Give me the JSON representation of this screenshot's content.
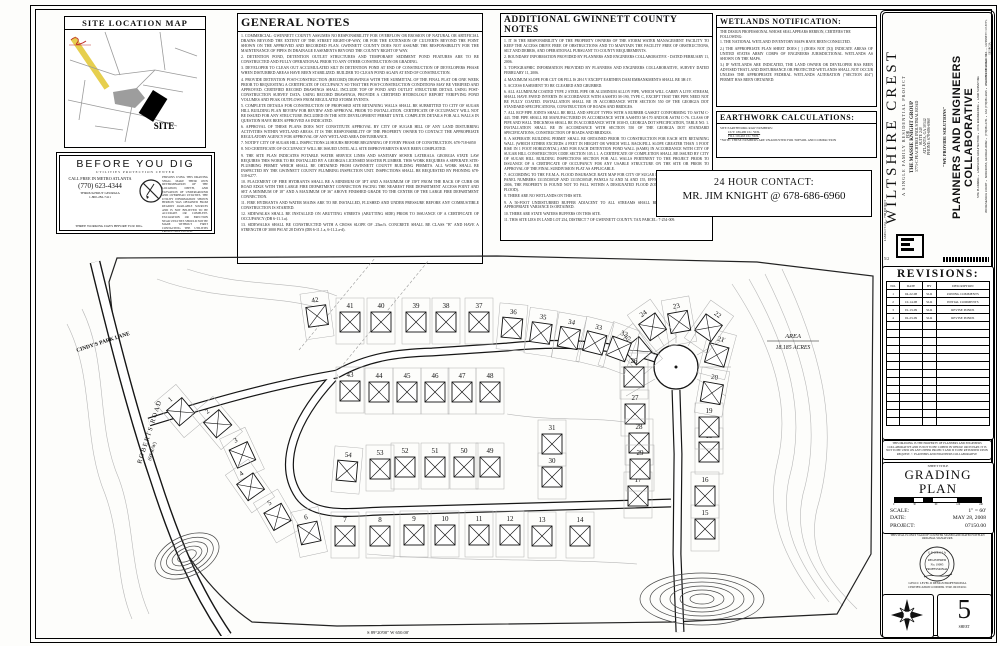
{
  "site_map": {
    "title": "SITE LOCATION MAP",
    "site_label": "SITE"
  },
  "before_you_dig": {
    "title": "BEFORE  YOU  DIG",
    "subtitle": "UTILITIES  PROTECTION  CENTER",
    "call_line": "CALL FREE IN METRO ATLANTA",
    "phone": "(770) 623-4344",
    "line2": "THROUGHOUT GEORGIA",
    "phone2": "1-800-282-7411",
    "bottom": "THREE  WORKING  DAYS  BEFORE  YOU  DIG.",
    "disclaimer": "PERSONS USING THIS DRAWING SHALL MAKE THEIR OWN DETERMINATION OF THE LOCATION, DEPTH, AND ELEVATION OF UNDERGROUND AND OVERHEAD UTILITIES. THE UTILITY INFORMATION SHOWN HEREON WAS OBTAINED FROM READILY AVAILABLE SOURCES AND IS NOT BELIEVED TO BE ACCURATE OR COMPLETE. EXCAVATION OR ERECTION NEAR UTILITIES SHOULD NOT BE MADE WITHOUT FIRST CONTACTING THE UTILITIES PROTECTION CENTER."
  },
  "general_notes": {
    "title": "GENERAL NOTES",
    "notes": [
      "1. COMMERCIAL: GWINNETT COUNTY ASSUMES NO RESPONSIBILITY FOR OVERFLOW OR EROSION OF NATURAL OR ARTIFICIAL DRAINS BEYOND THE EXTENT OF THE STREET RIGHT-OF-WAY, OR FOR THE EXTENSION OF CULVERTS BEYOND THE POINT SHOWN ON THE APPROVED AND RECORDED PLAN. GWINNETT COUNTY DOES NOT ASSUME THE RESPONSIBILITY FOR THE MAINTENANCE OF PIPES IN DRAINAGE EASEMENTS BEYOND THE COUNTY RIGHT OF WAY.",
      "2. DETENTION POND, DETENTION OUTLET STRUCTURES AND TEMPORARY SEDIMENT POND FEATURES ARE TO BE CONSTRUCTED AND FULLY OPERATIONAL PRIOR TO ANY OTHER CONSTRUCTION OR GRADING.",
      "3. DEVELOPER TO CLEAN OUT ACCUMULATED SILT IN DETENTION POND AT END OF CONSTRUCTION OF DEVELOPERS PHASE WHEN DISTURBED AREAS HAVE BEEN STABILIZED. BUILDER TO CLEAN POND AGAIN AT END OF CONSTRUCTION.",
      "4. PROVIDE DETENTION POST-CONSTRUCTION (RECORD) DRAWINGS WITH THE SUBMITTAL OF THE FINAL PLAT OR ONE WEEK PRIOR TO REQUESTING A CERTIFICATE OF OCCUPANCY SO THAT THE POST-CONSTRUCTION CONDITIONS MAY BE VERIFIED AND APPROVED. CERTIFIED RECORD DRAWINGS SHALL INCLUDE TOP OF POND AND OUTLET STRUCTURE DETAIL USING POST-CONSTRUCTION SURVEY DATA. USING RECORD DRAWINGS, PROVIDE A CERTIFIED HYDROLOGY REPORT VERIFYING POND VOLUMES AND PEAK OUTFLOWS FROM REGULATED STORM EVENTS.",
      "5. COMPLETE DETAILS FOR CONSTRUCTION OF PROPOSED SITE RETAINING WALLS SHALL BE SUBMITTED TO CITY OF SUGAR HILL BUILDING PLAN REVIEW FOR REVIEW AND APPROVAL PRIOR TO INSTALLATION. CERTIFICATE OF OCCUPANCY WILL NOT BE ISSUED FOR ANY STRUCTURE INCLUDED IN THE SITE DEVELOPMENT PERMIT UNTIL COMPLETE DETAILS FOR ALL WALLS IN QUESTION HAVE BEEN APPROVED AS INDICATED.",
      "6. APPROVAL OF THESE PLANS DOES NOT CONSTITUTE APPROVAL BY CITY OF SUGAR HILL OF ANY LAND DISTURBING ACTIVITIES WITHIN WETLAND AREAS. IT IS THE RESPONSIBILITY OF THE PROPERTY OWNER TO CONTACT THE APPROPRIATE REGULATORY AGENCY FOR APPROVAL OF ANY WETLAND AREA DISTURBANCE.",
      "7. NOTIFY CITY OF SUGAR HILL INSPECTIONS 24 HOURS BEFORE BEGINNING OF EVERY PHASE OF CONSTRUCTION. 678-718-6050",
      "8. NO CERTIFICATE OF OCCUPANCY WILL BE ISSUED UNTIL ALL SITE IMPROVEMENTS HAVE BEEN COMPLETED.",
      "9. THE SITE PLAN INDICATES POTABLE WATER SERVICE LINES AND SANITARY SEWER LATERALS. GEORGIA STATE LAW REQUIRES THIS WORK TO BE INSTALLED BY A GEORGIA LICENSED MASTER PLUMBER. THIS WORK REQUIRES A SEPERATE SITE-PLUMBING PERMIT WHICH SHALL BE OBTAINED FROM GWINNETT COUNTY BUILDING PERMITS. ALL WORK SHALL BE INSPECTED BY THE GWINNETT COUNTY PLUMBING INSPECTION UNIT. INSPECTIONS SHALL BE REQUESTED BY PHONING 678-518-6277.",
      "10. PLACEMENT OF FIRE HYDRANTS SHALL BE A MINIMUM OF 3FT AND A MAXIMUM OF 15FT FROM THE BACK OF CURB OR ROAD EDGE WITH THE LARGE FIRE DEPARTMENT CONNECTION FACING THE NEAREST FIRE DEPARTMENT ACCESS POINT AND SET A MINIMUM OF 18\" AND A MAXIMUM OF 36\" ABOVE FINISHED GRADE TO THE CENTER OF THE LARGE FIRE DEPARTMENT CONNECTION.",
      "11. FIRE HYDRANTS AND WATER MAINS ARE TO BE INSTALLED, FLUSHED AND UNDER PRESSURE BEFORE ANY COMBUSTIBLE CONSTRUCTION IS STARTED.",
      "12. SIDEWALKS SHALL BE INSTALLED ON ABUTTING STREETS (ABUTTING SIDE) PRIOR TO ISSUANCE OF A CERTIFICATE OF OCCUPANCY (DB 6-11.1.a).",
      "13. SIDEWALKS SHALL BE CONSTRUCTED WITH A CROSS SLOPE OF .25in/ft. CONCRETE SHALL BE CLASS \"B\" AND HAVE A STRENGTH OF 3000 PSI AT 28 DAYS (DB 6-11.1.a, 6-11.2.a-d)."
    ]
  },
  "county_notes": {
    "title": "ADDITIONAL GWINNETT COUNTY NOTES",
    "notes": [
      "1. IT IS THE RESPONSIBILITY OF THE PROPERTY OWNERS OF THE STORM WATER MANAGEMENT FACILITY TO KEEP THE ACCESS DRIVE FREE OF OBSTRUCTIONS AND TO MAINTAIN THE FACILITY FREE OF OBSTRUCTIONS, SILT AND DEBRIS, AND OPERATIONAL PURSUANT TO COUNTY REQUIREMENTS.",
      "2. BOUNDARY INFORMATION PROVIDED BY PLANNERS AND ENGINEERS COLLABORATIVE - DATED FEBRUARY 11, 2006.",
      "3. TOPOGRAPHIC INFORMATION PROVIDED BY PLANNERS AND ENGINEERS COLLABORATIVE, SURVEY DATED FEBRUARY 11, 2006.",
      "4. MAXIMUM SLOPE FOR CUT OR FILL IS 2H:1V EXCEPT EARTHEN DAM EMBANKMENTS SHALL BE 3H:1V.",
      "5. ACCESS EASEMENT TO BE CLEARED AND GRUBBED.",
      "6. ALL ALUMINUM COATED TYPE 2 STEEL PIPE OR ALUMINUM ALLOY PIPE, WHICH WILL CARRY A LIVE STREAM, SHALL HAVE PAVED INVERTS IN ACCORDANCE WITH AASHTO M-190, TYPE C, EXCEPT THAT THE PIPE NEED NOT BE FULLY COATED. INSTALLATION SHALL BE IN ACCORDANCE WITH SECTION 550 OF THE GEORGIA DOT STANDARD SPECIFICATIONS, CONSTRUCTION OF ROADS AND BRIDGES.",
      "7. ALL RCP PIPE JOINTS SHALL BE BELL AND SPIGOT TYPES WITH A RUBBER GASKET CONFORMING TO ASTM C-443. THE PIPE SHALL BE MANUFACTURED IN ACCORDANCE WITH AASHTO M-170 AND/OR ASTM C-76. CLASS OF PIPE AND WALL THICKNESS SHALL BE IN ACCORDANCE WITH 1030-D, GEORGIA DOT SPECIFICATION, TABLE NO. 1. INSTALLATION SHALL BE IN ACCORDANCE WITH SECTION 550 OF THE GEORGIA DOT STANDARD SPECIFICATIONS, CONSTRUCTION OF ROADS AND BRIDGES.",
      "8. A SEPERATE BUILDING PERMIT SHALL BE OBTAINED PRIOR TO CONSTRUCTION FOR EACH SITE RETAINING WALL (WHICH EITHER EXCEEDS 4 FEET IN HEIGHT OR WHICH WILL BACK/FILL SLOPE GREATER THAN 3 FOOT RISE IN 1 FOOT HORIZONTAL) AND FOR EACH DETENTION POND WALL (SAME) IN ACCORDANCE WITH CITY OF SUGAR HILL CONSTRUCTION CODE SECTION 105.1.1. A CERTIFICATE OF COMPLETION SHALL BE ISSUED BY CITY OF SUGAR HILL BUILDING INSPECTIONS SECTION FOR ALL WALLS PERTINENT TO THE PROJECT PRIOR TO ISSUANCE OF A CERTIFICATE OF OCCUPANCY FOR ANY USABLE STRUCTURE ON THE SITE OR PRIOR TO APPROVAL OF THE FINAL SUBDIVISION PLAT AS APPLICABLE.",
      "7. ACCORDING TO THE F.E.M.A. FLOOD INSURANCE RATE MAP FOR CITY OF SUGAR HILL, GEORGIA, COMMUNITY PANEL NUMBERS 13135C0052F AND 13135C0054F, PANELS 52 AND 54 AND 155, EFFECTIVE DATE SEPTEMBER 29, 2006, THE PROPERTY IS FOUND NOT TO FALL WITHIN A DESIGNATED FLOOD ZONE \"A\" (AREAS OF 100 YEAR FLOOD).",
      "8. THERE ARE NO WETLANDS ON THIS SITE.",
      "9. A 50-FOOT UNDISTURBED BUFFER ADJACENT TO ALL STREAMS SHALL BE MAINTAINED UNLESS AN APPROPRIATE VARIANCE IS OBTAINED.",
      "10. THERE ARE STATE WATERS BUFFERS ON THIS SITE.",
      "11. THIS SITE LIES IN LAND LOT 254, DISTRICT 7 OF GWINNETT COUNTY. TAX PARCEL: 7-254-009."
    ]
  },
  "wetlands": {
    "title": "WETLANDS NOTIFICATION:",
    "intro": "THE DESIGN PROFESSIONAL WHOSE SEAL APPEARS HEREON, CERTIFIES THE FOLLOWING:",
    "items": [
      "1. THE NATIONAL WETLAND INVENTORY MAPS HAVE BEEN CONSULTED.",
      "2.) THE APPROPRIATE PLAN SHEET DOES [ ] (DOES NOT [X]) INDICATE AREAS OF UNITED STATES ARMY CORPS OF ENGINEERS JURISDICTIONAL WETLANDS AS SHOWN ON THE MAPS.",
      "3.) IF WETLANDS ARE INDICATED, THE LAND OWNER OR DEVELOPER HAS BEEN ADVISED THAT LAND DISTURBANCE OR PROTECTED WETLANDS SHALL NOT OCCUR UNLESS THE APPROPRIATE FEDERAL WETLANDS ALTERATION (\"SECTION 404\") PERMIT HAS BEEN OBTAINED."
    ]
  },
  "earthwork": {
    "title": "EARTHWORK CALCULATIONS:",
    "lines": [
      "SITE EARTHWORK RAW NUMBERS:",
      "CUT: 186,480 CU. YDS.",
      "FILL: 69,463 CU. YDS.",
      "*NOTE: THESE NUMBERS ARE UNADJUSTED FOR TOPSOIL AND COMPACTION"
    ]
  },
  "contact": {
    "line1": "24 HOUR CONTACT:",
    "line2": "MR. JIM KNIGHT @ 678-686-6960"
  },
  "title_block": {
    "project": "WILTSHIRE CREST",
    "subtitle": "A SINGLE FAMILY RESIDENTIAL PROJECT",
    "for_label": "FOR",
    "client": "THE MASSIE KNIGHT GROUP",
    "addr1": "3773-C PEACHTREE INDUSTRIAL ROAD",
    "addr2": "SUITE 240",
    "addr3": "ATLANTA, GA 30342",
    "phone": "PHONE: 678-686-6960",
    "corner_top": "CITY OF SUGAR HILL — GWINNETT COUNTY, GEORGIA",
    "corner_bottom": "LAND LOT 254 — 7TH DISTRICT"
  },
  "firm": {
    "tagline": "\"WE PROVIDE SOLUTIONS\"",
    "name": "PLANNERS  AND  ENGINEERS  COLLABORATIVE",
    "services": "SITE PLANNING ▪ LANDSCAPE ARCHITECTURE ▪ CIVIL ENGINEERING ▪ LAND SURVEYING",
    "address": "350 RESEARCH COURT ▪ NORCROSS, GEORGIA 30092 ▪ (770)451-2741 ▪ FAX (770)451-3915 ▪ WWW.PECATL.COM"
  },
  "stamp": {
    "text": "5/2"
  },
  "revisions": {
    "title": "REVISIONS:",
    "headers": [
      "NO.",
      "DATE",
      "BY",
      "DESCRIPTION"
    ],
    "rows": [
      [
        "1",
        "04-22-08",
        "SLR",
        "ZONING COMMENTS"
      ],
      [
        "2",
        "10-14-08",
        "SLR",
        "INITIAL COMMENTS"
      ],
      [
        "3",
        "01-13-09",
        "SLR",
        "REVISE PONDS"
      ],
      [
        "4",
        "02-23-09",
        "SLR",
        "REVISE PONDS"
      ]
    ]
  },
  "ownership_note": "THIS DRAWING IS THE PROPERTY OF PLANNERS AND ENGINEERS COLLABORATIVE AND IS NOT TO BE COPIED IN WHOLE OR IN PART. IT IS NOT TO BE USED ON ANY OTHER PROJECT AND IS TO BE RETURNED UPON REQUEST. © PLANNERS AND ENGINEERS COLLABORATIVE",
  "sheet_title_block": {
    "label": "SHEET TITLE",
    "title1": "GRADING",
    "title2": "PLAN",
    "scale_ticks": [
      "0",
      "30",
      "60",
      "120",
      "240"
    ],
    "scale_label": "SCALE:",
    "scale_value": "1\" = 60'",
    "date_label": "DATE:",
    "date_value": "MAY 28, 2008",
    "project_label": "PROJECT:",
    "project_value": "07150.00"
  },
  "seal": {
    "note": "THIS SEAL IS ONLY VALID IF COUNTER SIGNED AND DATED WITH AN ORIGINAL SIGNATURE.",
    "arc": "G E O R G I A",
    "line1": "REGISTERED",
    "line2": "No. 19095",
    "line3": "PROFESSIONAL",
    "gswcc1": "GSWCC LEVEL II DESIGN PROFESSIONAL",
    "gswcc2": "CERTIFICATION # 0000069 / EXP. 06/03/2011"
  },
  "sheet_number": {
    "value": "5",
    "label": "SHEET"
  },
  "plan": {
    "road1a": "ROBERTS ROAD",
    "road1b": "(60' R/W)",
    "road2": "CINDY'S PARK LANE",
    "area1": "AREA",
    "area2": "18.185  ACRES",
    "bearing": "S 89°20'00\" W   650.00'",
    "lots": [
      [
        "1",
        143,
        157,
        -40
      ],
      [
        "2",
        180,
        169,
        -40
      ],
      [
        "3",
        205,
        200,
        -25
      ],
      [
        "4",
        213,
        232,
        -35
      ],
      [
        "5",
        240,
        262,
        -30
      ],
      [
        "6",
        272,
        278,
        -12
      ],
      [
        "7",
        308,
        281,
        0
      ],
      [
        "8",
        343,
        281,
        0
      ],
      [
        "9",
        377,
        280,
        0
      ],
      [
        "10",
        408,
        280,
        0
      ],
      [
        "11",
        442,
        280,
        0
      ],
      [
        "12",
        473,
        280,
        0
      ],
      [
        "13",
        505,
        281,
        0
      ],
      [
        "14",
        543,
        281,
        0
      ],
      [
        "15",
        668,
        274,
        0
      ],
      [
        "16",
        668,
        241,
        0
      ],
      [
        "17",
        601,
        241,
        0
      ],
      [
        "18",
        672,
        197,
        0
      ],
      [
        "19",
        672,
        172,
        0
      ],
      [
        "20",
        675,
        138,
        10
      ],
      [
        "21",
        680,
        100,
        15
      ],
      [
        "22",
        672,
        73,
        35
      ],
      [
        "23",
        642,
        67,
        -10
      ],
      [
        "24",
        615,
        72,
        -35
      ],
      [
        "25",
        600,
        96,
        -40
      ],
      [
        "26",
        597,
        122,
        0
      ],
      [
        "27",
        598,
        159,
        0
      ],
      [
        "28",
        602,
        188,
        0
      ],
      [
        "29",
        603,
        214,
        0
      ],
      [
        "30",
        515,
        222,
        0
      ],
      [
        "31",
        515,
        189,
        0
      ],
      [
        "32",
        582,
        94,
        20
      ],
      [
        "33",
        558,
        88,
        14
      ],
      [
        "34",
        532,
        83,
        10
      ],
      [
        "35",
        504,
        78,
        8
      ],
      [
        "36",
        475,
        73,
        5
      ],
      [
        "37",
        442,
        67,
        0
      ],
      [
        "38",
        409,
        67,
        0
      ],
      [
        "39",
        379,
        67,
        0
      ],
      [
        "40",
        344,
        67,
        0
      ],
      [
        "41",
        313,
        67,
        0
      ],
      [
        "42",
        280,
        61,
        -8
      ],
      [
        "43",
        313,
        136,
        0
      ],
      [
        "44",
        342,
        137,
        0
      ],
      [
        "45",
        370,
        137,
        0
      ],
      [
        "46",
        398,
        137,
        0
      ],
      [
        "47",
        425,
        137,
        0
      ],
      [
        "48",
        453,
        137,
        0
      ],
      [
        "49",
        453,
        212,
        0
      ],
      [
        "50",
        427,
        212,
        0
      ],
      [
        "51",
        398,
        212,
        0
      ],
      [
        "52",
        368,
        212,
        0
      ],
      [
        "53",
        343,
        214,
        0
      ],
      [
        "54",
        310,
        216,
        5
      ]
    ]
  }
}
